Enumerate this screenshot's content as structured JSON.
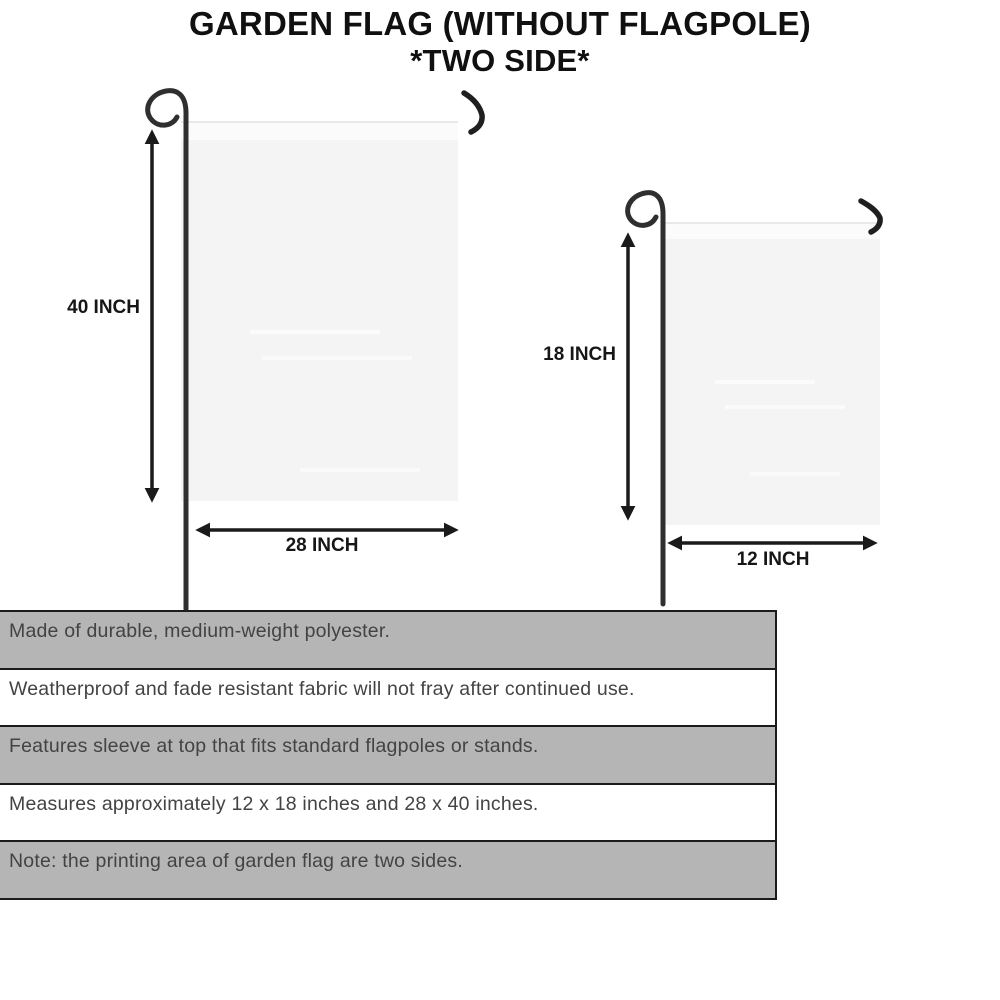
{
  "title": {
    "line1": "GARDEN FLAG (WITHOUT FLAGPOLE)",
    "line2": "*TWO SIDE*"
  },
  "flags": {
    "large": {
      "height_label": "40 INCH",
      "width_label": "28 INCH"
    },
    "small": {
      "height_label": "18 INCH",
      "width_label": "12 INCH"
    }
  },
  "features": [
    "Made of durable, medium-weight polyester.",
    "Weatherproof and fade resistant fabric will not fray after continued use.",
    "Features sleeve at top that fits standard flagpoles or stands.",
    "Measures approximately 12 x 18 inches and 28 x 40 inches.",
    "Note: the printing area of garden flag are two sides."
  ],
  "colors": {
    "background": "#ffffff",
    "title_text": "#101010",
    "flag_fill": "#f4f4f5",
    "flag_sleeve": "#fbfbfc",
    "pole": "#2f2f2f",
    "arrow": "#1a1a1a",
    "stripe_gray": "#b5b5b5",
    "bar_border": "#1b1b1b",
    "feature_text": "#434343"
  }
}
